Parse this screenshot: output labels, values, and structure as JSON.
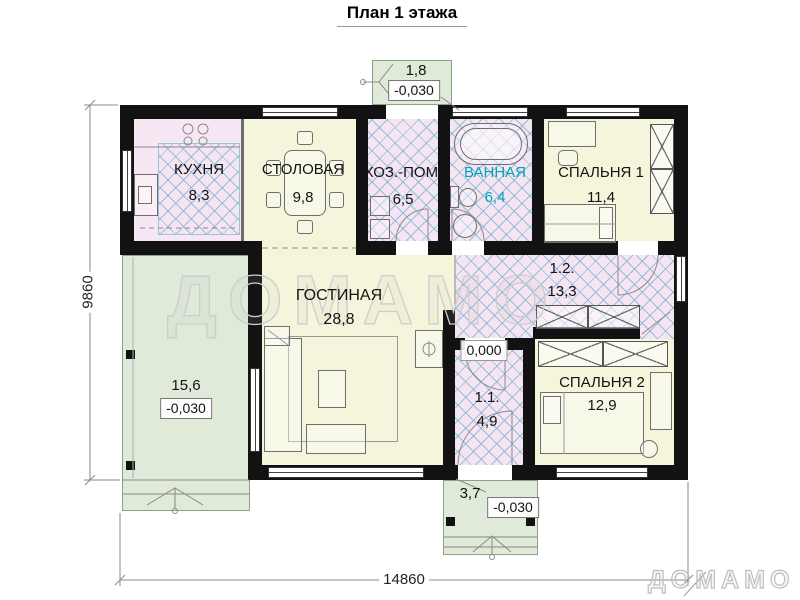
{
  "title": "План 1 этажа",
  "watermark": "ДОМАМО",
  "brand": "ДОМАМО",
  "dimensions": {
    "overall_width": "14860",
    "overall_height": "9860"
  },
  "levels": {
    "ground_floor": "0,000",
    "outdoor": "-0,030"
  },
  "rooms": {
    "kitchen": {
      "label": "КУХНЯ",
      "area": "8,3"
    },
    "dining": {
      "label": "СТОЛОВАЯ",
      "area": "9,8"
    },
    "utility": {
      "label": "ХОЗ.-ПОМ.",
      "area": "6,5"
    },
    "bathroom": {
      "label": "ВАННАЯ",
      "area": "6,4"
    },
    "bedroom1": {
      "label": "СПАЛЬНЯ 1",
      "area": "11,4"
    },
    "living": {
      "label": "ГОСТИНАЯ",
      "area": "28,8"
    },
    "corridor": {
      "label": "1.2.",
      "area": "13,3"
    },
    "hall": {
      "label": "1.1.",
      "area": "4,9"
    },
    "bedroom2": {
      "label": "СПАЛЬНЯ 2",
      "area": "12,9"
    }
  },
  "outdoor": {
    "terrace": {
      "area": "15,6",
      "level": "-0,030"
    },
    "porch_top": {
      "area": "1,8",
      "level": "-0,030"
    },
    "porch_bottom": {
      "area": "3,7",
      "level": "-0,030"
    }
  },
  "colors": {
    "wall": "#121212",
    "dry_room_fill": "#f5f5dc",
    "wet_room_fill": "#f5e4f1",
    "hatch_line": "#6eafcd",
    "outdoor_fill": "#dfead9",
    "bathroom_label": "#00a5bd",
    "watermark_outline": "#cdcdcd"
  }
}
